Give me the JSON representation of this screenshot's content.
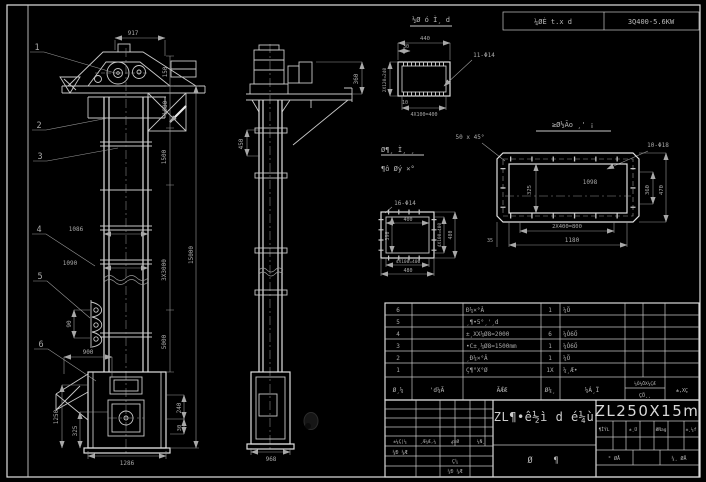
{
  "header": {
    "process": "¼ØÈ t.x d",
    "spec": "3Q400-5.6KW"
  },
  "front": {
    "c1": "1",
    "c2": "2",
    "c3": "3",
    "c4": "4",
    "c5": "5",
    "c6": "6",
    "w917": "917",
    "h150": "150",
    "h1080": "1080",
    "h1500": "1500",
    "h3x3000": "3X3000",
    "h5000": "5000",
    "h15000": "15000",
    "w1086": "1086",
    "w1090": "1090",
    "v90": "90",
    "w900": "900",
    "v1250": "1250",
    "v325": "325",
    "v240": "240",
    "v30": "30",
    "w1286": "1286"
  },
  "side": {
    "v450": "450",
    "v360": "360",
    "w968": "968"
  },
  "det1": {
    "title": "½Ø ó Ì¸ d",
    "w440": "440",
    "e30": "30",
    "holes": "11-Φ14",
    "left": "2X120=240",
    "e10": "10",
    "bottom": "4X100=400"
  },
  "det2": {
    "title": "≥Ø½Ão ¸' ¡",
    "chamfer": "50 x 45°",
    "holes": "10-Φ18",
    "w1098": "1098",
    "v325": "325",
    "v360": "360",
    "v470": "470",
    "b800": "2X400=800",
    "b1180": "1180",
    "e35": "35"
  },
  "det3": {
    "holes": "16-Φ14",
    "t400": "400",
    "l390": "390",
    "r400": "4X100=400",
    "r480": "480",
    "b400": "4X100=400",
    "b480": "480"
  },
  "notes": {
    "line1": "Ø¶¸ Ì¸ ¸",
    "line2": "¶ô Øý ×°"
  },
  "bom": {
    "h1": "Ø¸¼",
    "h2": "'d¼Ã",
    "h3": "ÃǼÆ",
    "h4": "Ø¼¸",
    "h5": "¼Á¸Ï",
    "h6a": "¼Ò¼ÖX¼ÇÆ",
    "h6b": "ÇÖ¸¸",
    "h7": "±,XÇ",
    "rows": [
      {
        "no": "6",
        "name": "Ð¼×°Â",
        "qty": "1",
        "mat": "¼Ö"
      },
      {
        "no": "5",
        "name": "¸¶•5°¸'¸d",
        "qty": "",
        "mat": ""
      },
      {
        "no": "4",
        "name": "±¸XX¼Ø8=2000",
        "qty": "6",
        "mat": "¼Ò6Ö"
      },
      {
        "no": "3",
        "name": "•C±¸¼Ø8=1500mm",
        "qty": "1",
        "mat": "¼Ò6Ö"
      },
      {
        "no": "2",
        "name": "¸Ð¼×°Â",
        "qty": "1",
        "mat": "¼Ö"
      },
      {
        "no": "1",
        "name": "Ç¶°X°Ø",
        "qty": "1X",
        "mat": "¼¸Æ•"
      }
    ]
  },
  "tb": {
    "model": "ZL250X15m",
    "title": "ZL¶•ê½ì d é¼ù",
    "g1": "Ø",
    "g2": "¶",
    "r1": "±¼Ç|¼",
    "r2": "¸Æ¼Æ,¼",
    "r3": "ؼ×Ø",
    "r4": "¼Ñ¸",
    "design": "¼Ð ¼Æ",
    "chk": "Ç¼",
    "chk2": "¼Ð ¼Æ",
    "s1": "¶ÎÝL",
    "s2": "±¸Ü",
    "s3": "ØÑag",
    "s4": "±¸¼f",
    "sheet1": "° ØÅ",
    "sheet2": "¼¸ ØÅ"
  }
}
